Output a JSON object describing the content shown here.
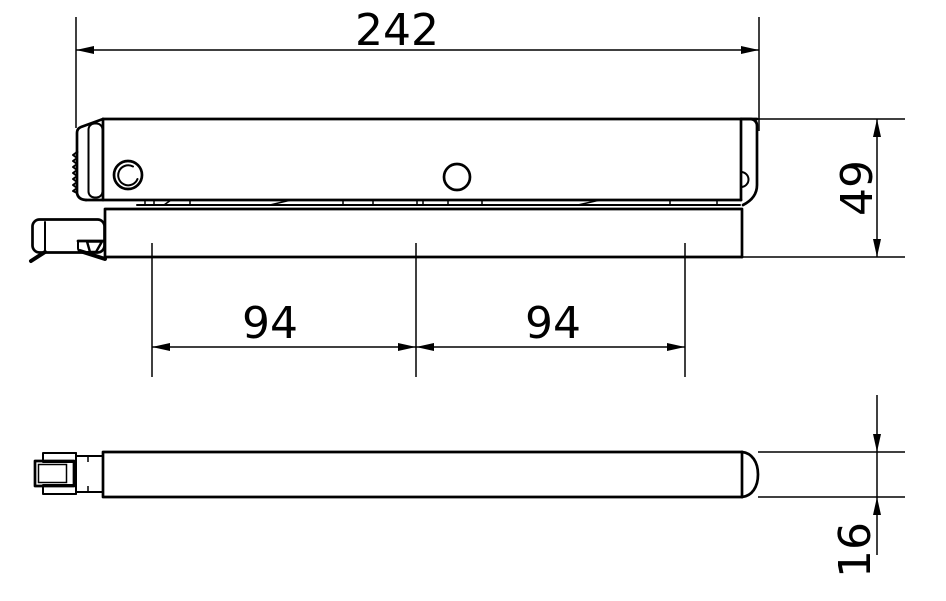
{
  "drawing": {
    "colors": {
      "line": "#000000",
      "background": "#ffffff"
    },
    "dimensions": {
      "overall_length": "242",
      "overall_depth": "49",
      "span_left": "94",
      "span_right": "94",
      "thickness": "16"
    }
  }
}
